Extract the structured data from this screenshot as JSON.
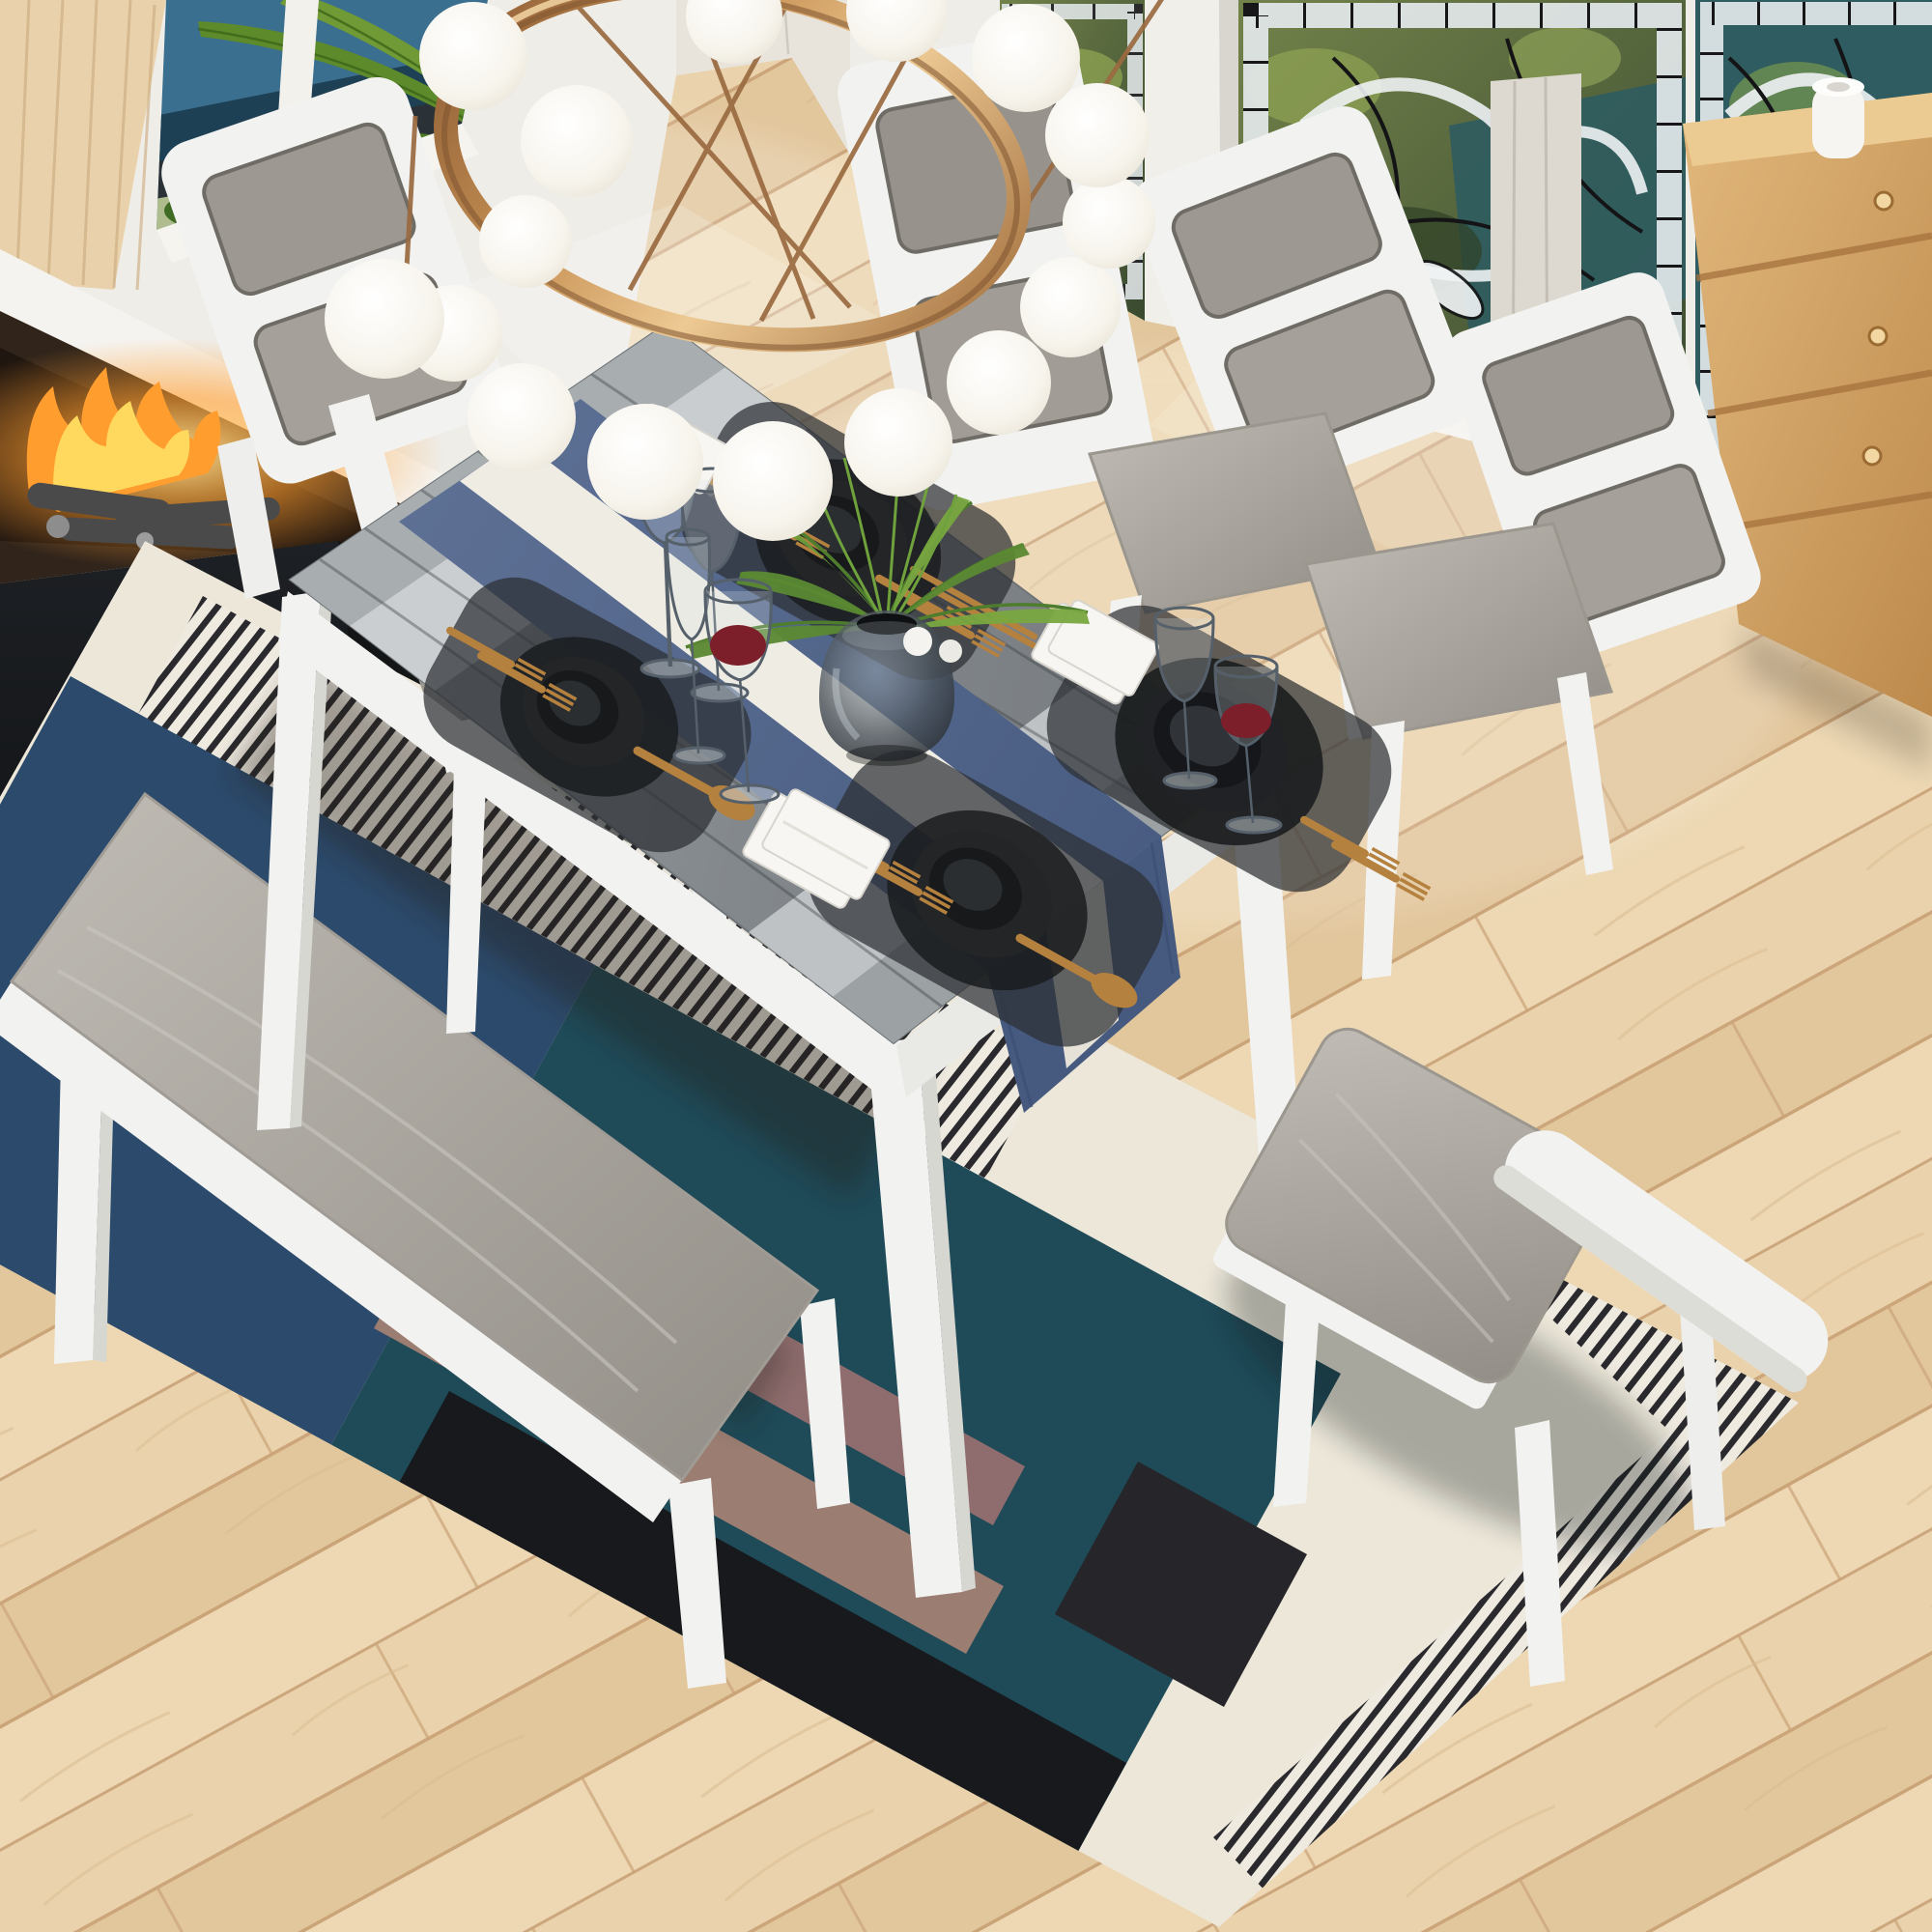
{
  "image_type": "3d-rendered product photo",
  "subject": "6-piece dining table set with bench in sunlit dining room",
  "palette": {
    "floor_base": "#e8d0a9",
    "floor_seam": "#c49a6e",
    "wall_white": "#efede8",
    "wood_wall": "#e9d2ab",
    "wood_wall_grain": "#caa97c",
    "window_water": "#3a6f8f",
    "window_deep_water": "#1d4054",
    "window_rock": "#2a3238",
    "palm_green": "#5d8a2b",
    "palm_dark": "#3c6418",
    "stained_glass_green": "#5c6e3e",
    "stained_glass_teal": "#2f5c60",
    "stained_glass_white": "#e9edf0",
    "stained_glass_line": "#17171a",
    "cabinet_wood": "#d5a368",
    "cabinet_seam": "#a5713d",
    "cabinet_knob": "#f2d7a2",
    "jar_white": "#f6f5f2",
    "mantel_white": "#f5f3ef",
    "firebox_bronze": "#30241b",
    "flame_yellow": "#ffd95e",
    "flame_orange": "#ff9d2e",
    "marble_black": "#131517",
    "ring_gold": "#c89255",
    "ring_gold_dark": "#7d5330",
    "globe_white": "#ffffff",
    "table_top_gray": "#878c90",
    "table_light_band": "#cfd3d5",
    "table_end_cap": "#a8adb0",
    "furniture_white": "#f2f2f0",
    "furniture_shade": "#d7d7d2",
    "cushion_gray": "#b0aca5",
    "runner_blue": "#54678e",
    "runner_white": "#efece4",
    "placemat_dark": "#2c2f33",
    "plate_black": "#232527",
    "bowl_black": "#17191b",
    "cutlery_gold": "#b5813f",
    "wine_red": "#7c1f2a",
    "napkin_white": "#f7f6f2",
    "vase_smoke": "#3a4046",
    "fern_green": "#4e7d2d",
    "fern_light": "#79a741",
    "rug_cream": "#ece7d9",
    "rug_navy": "#2c4a6b",
    "rug_teal": "#1f4a58",
    "rug_black": "#17191c",
    "rug_mauve": "#8f6d6e",
    "rug_pinstripe": "#26262a"
  },
  "room": {
    "floor": {
      "material": "light oak diagonal planks"
    },
    "left_wall": {
      "features": [
        "tall wood panel",
        "ocean and palm window",
        "white frames"
      ]
    },
    "corner_wall": {
      "features": [
        "pale plank sliver",
        "white pillar"
      ]
    },
    "right_wall": {
      "stained_glass_panels": 3,
      "views": [
        "palm fronds",
        "teal water"
      ]
    },
    "fireplace": {
      "mantel": "white",
      "firebox": "bronze speckled",
      "state": "lit",
      "body": "black marble"
    },
    "cabinet": {
      "drawers": 3,
      "knobs": 3,
      "top_item": "white jar"
    }
  },
  "chandelier": {
    "type": "gold ring with glass globes",
    "globes": 16,
    "rods": 6
  },
  "dining_set": {
    "table": {
      "top": "gray wood with light bands",
      "frame": "white",
      "legs": 3
    },
    "runner": {
      "style": "blue with white center stripe",
      "drape": "right end"
    },
    "chairs": [
      {
        "id": "chair-left-head"
      },
      {
        "id": "chair-far-left"
      },
      {
        "id": "chair-far-right"
      },
      {
        "id": "chair-right-head"
      },
      {
        "id": "chair-pulled-out"
      }
    ],
    "bench": {
      "cushion": "gray",
      "legs": 3
    }
  },
  "tableware": {
    "place_settings": 4,
    "wine_glasses": 6,
    "glasses_with_red_wine": 2,
    "napkin_stacks": 3,
    "chopstick_pair": 1,
    "vase": {
      "contents": "fern sprays and grass blades"
    },
    "decor_spheres": 2
  },
  "rug": {
    "style": "geometric patchwork",
    "blocks": [
      "cream",
      "navy",
      "teal",
      "black",
      "mauve stripes",
      "pinstripe bands"
    ]
  }
}
